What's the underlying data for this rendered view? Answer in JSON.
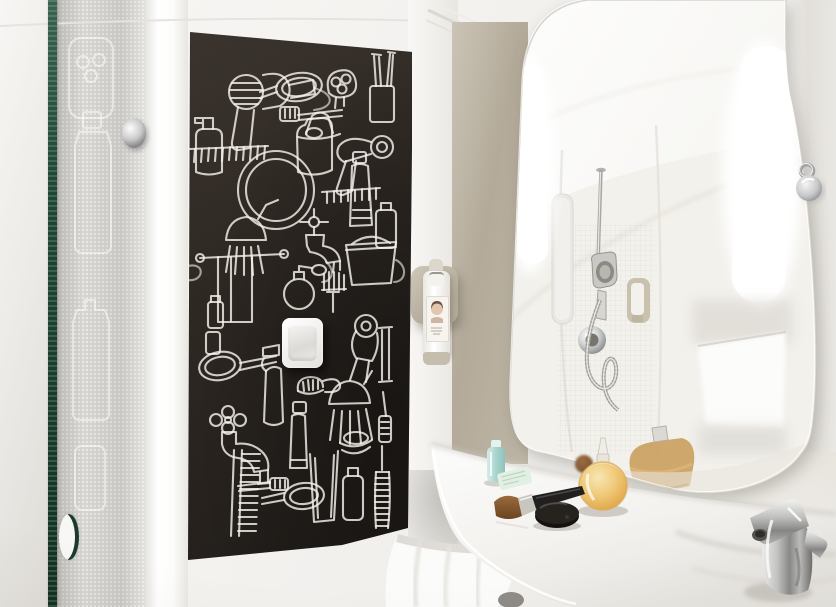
{
  "scene": {
    "type": "photograph",
    "description": "Hotel bathroom with a black wall mural of white line-drawn toiletries, an illuminated rounded mirror reflecting a shower, a curved white washbasin counter with cosmetics, and a glass shower door with a green glass edge",
    "style": "ibis-style hotel bathroom"
  },
  "palette": {
    "wall_white": "#f2f0ed",
    "mural_black": "#2b2522",
    "mural_line": "#f4f1ea",
    "glass_edge_green": "#1f4736",
    "frosted_glass": "#d7d5d1",
    "niche_beige": "#b3aa99",
    "mirror_white": "#fbfbfa",
    "light_glow": "#ffffff",
    "counter_white": "#f3f2f0",
    "chrome": "#b9babb",
    "perfume_amber": "#e9bc6d",
    "travel_bottle_aqua": "#a9d4cd",
    "sachet_mint": "#e1f0e3",
    "towel_white": "#fbfbf9"
  },
  "objects": {
    "shower_door": {
      "label": "Glass shower door with green edge"
    },
    "door_knob": {
      "label": "Chrome door knob"
    },
    "door_hole": {
      "label": "Finger hole handle in glass"
    },
    "mural": {
      "label": "Black toiletries line-art mural",
      "items": [
        "hair-dryer-icon",
        "hand-mirror-icon",
        "electric-shaver-icon",
        "toothbrush-cup-icon",
        "toothbrush-icon",
        "shampoo-jug-icon",
        "pump-bottle-icon",
        "comb-icon",
        "round-mirror-icon",
        "toothpaste-icon",
        "shower-head-icon",
        "towel-rail-icon",
        "tap-icon",
        "perfume-atomizer-icon",
        "afro-pick-icon",
        "bucket-icon",
        "spray-bottle-icon",
        "shaving-brush-icon",
        "squeegee-icon",
        "mascara-icon",
        "drinking-glass-icon",
        "soap-dish-icon",
        "bottle-icon",
        "bottle-brush-icon"
      ]
    },
    "light_switch": {
      "label": "White rocker light switch"
    },
    "dispenser": {
      "label": "Wall-mounted toiletry dispenser bottle"
    },
    "mirror": {
      "label": "Illuminated rounded mirror"
    },
    "mirror_lights": {
      "label": "Vertical LED light strips"
    },
    "shower_reflection": {
      "label": "Reflected shower with hand shower on rail and mixer valve"
    },
    "wall_hook": {
      "label": "Chrome wall hook"
    },
    "counter": {
      "label": "Curved white washbasin counter"
    },
    "faucet": {
      "label": "Chrome basin mixer tap"
    },
    "towel": {
      "label": "White towel under counter"
    },
    "perfume_bottle": {
      "label": "Round amber perfume bottle with glass stopper"
    },
    "makeup_brush": {
      "label": "Makeup brush"
    },
    "compact": {
      "label": "Black compact mirror"
    },
    "travel_bottle": {
      "label": "Aqua travel bottle"
    },
    "sachet": {
      "label": "Mint toiletry sachet"
    },
    "powder_puff": {
      "label": "Small powder puff"
    }
  }
}
